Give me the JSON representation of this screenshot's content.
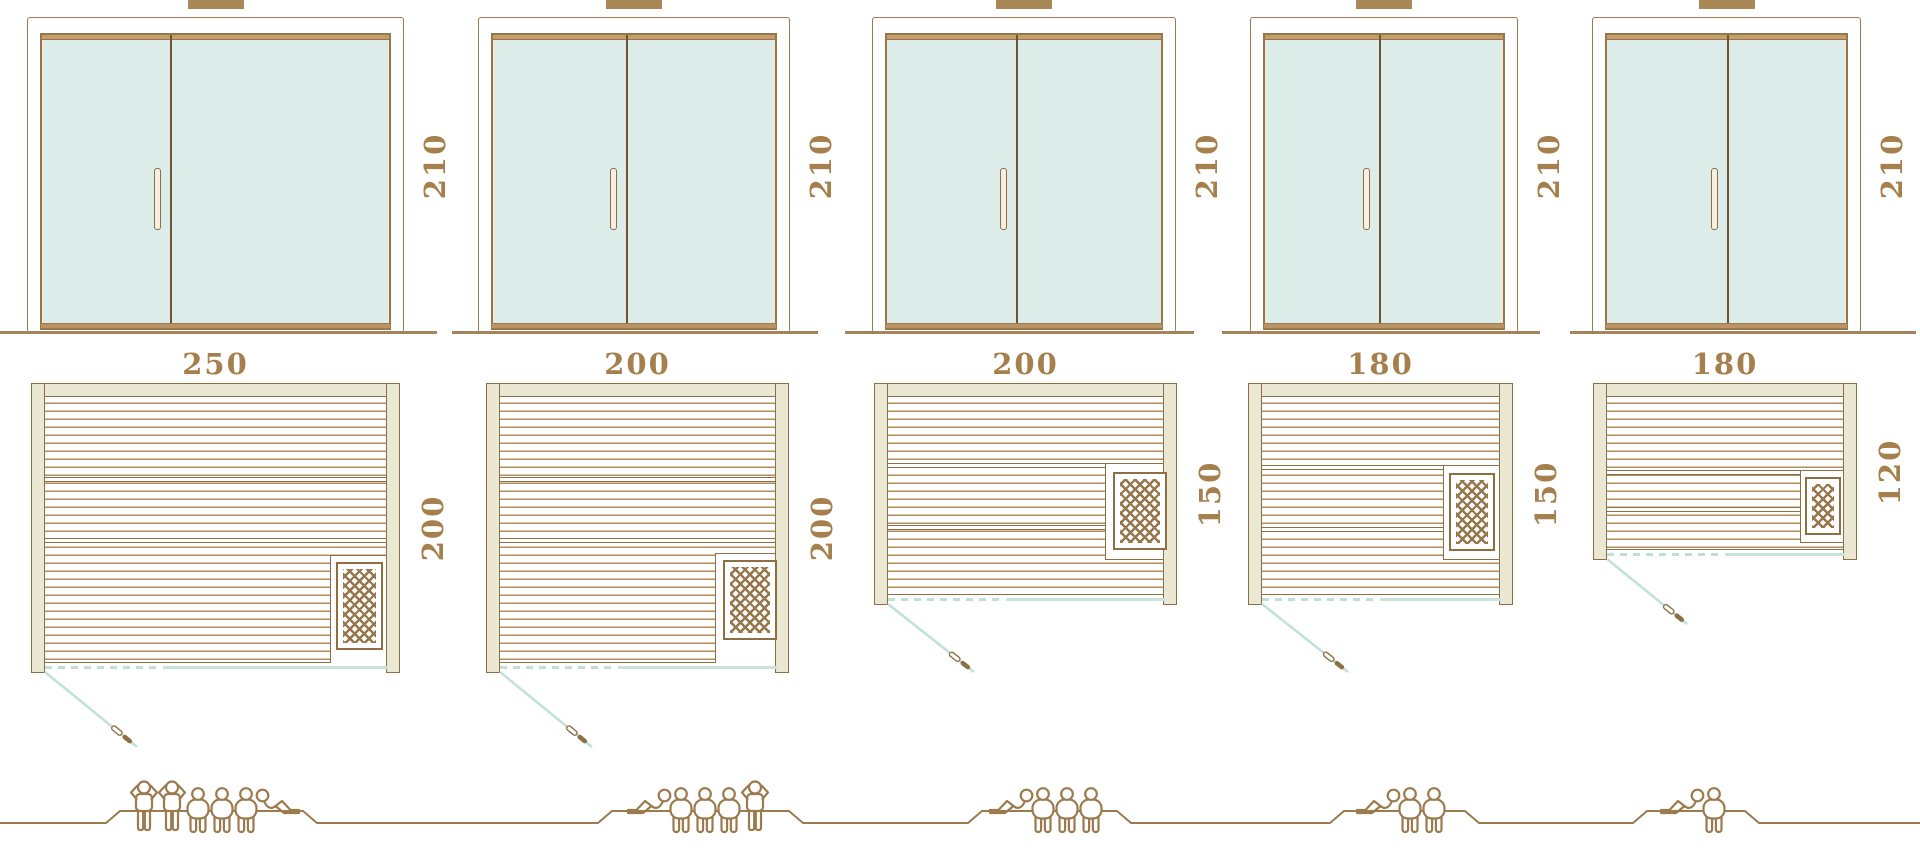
{
  "diagram": {
    "kind": "sauna-size-comparison"
  },
  "saunas": [
    {
      "door_height": "210",
      "width": "250",
      "depth": "200",
      "capacity": 6,
      "occupants": [
        "standing",
        "standing",
        "sitting",
        "sitting",
        "sitting",
        "lying"
      ]
    },
    {
      "door_height": "210",
      "width": "200",
      "depth": "200",
      "capacity": 5,
      "occupants": [
        "lying",
        "sitting",
        "sitting",
        "sitting",
        "standing"
      ]
    },
    {
      "door_height": "210",
      "width": "200",
      "depth": "150",
      "capacity": 4,
      "occupants": [
        "lying",
        "sitting",
        "sitting",
        "sitting"
      ]
    },
    {
      "door_height": "210",
      "width": "180",
      "depth": "150",
      "capacity": 3,
      "occupants": [
        "lying",
        "sitting",
        "sitting"
      ]
    },
    {
      "door_height": "210",
      "width": "180",
      "depth": "120",
      "capacity": 2,
      "occupants": [
        "lying",
        "sitting"
      ]
    }
  ],
  "colors": {
    "outline_brown": "#8d6f44",
    "line_brown": "#9a7a4e",
    "label_text": "#a57f4c",
    "door_glass": "#dcede9",
    "wall_fill": "#eae7d3",
    "wood_line": "#b08c5e",
    "teal_line": "#c2e1da",
    "threshold": "#bb9465",
    "vent": "#a98757"
  },
  "icons": {
    "person_standing": "person-standing-icon",
    "person_sitting": "person-sitting-icon",
    "person_lying": "person-lying-icon",
    "door_handle": "door-handle-icon"
  }
}
